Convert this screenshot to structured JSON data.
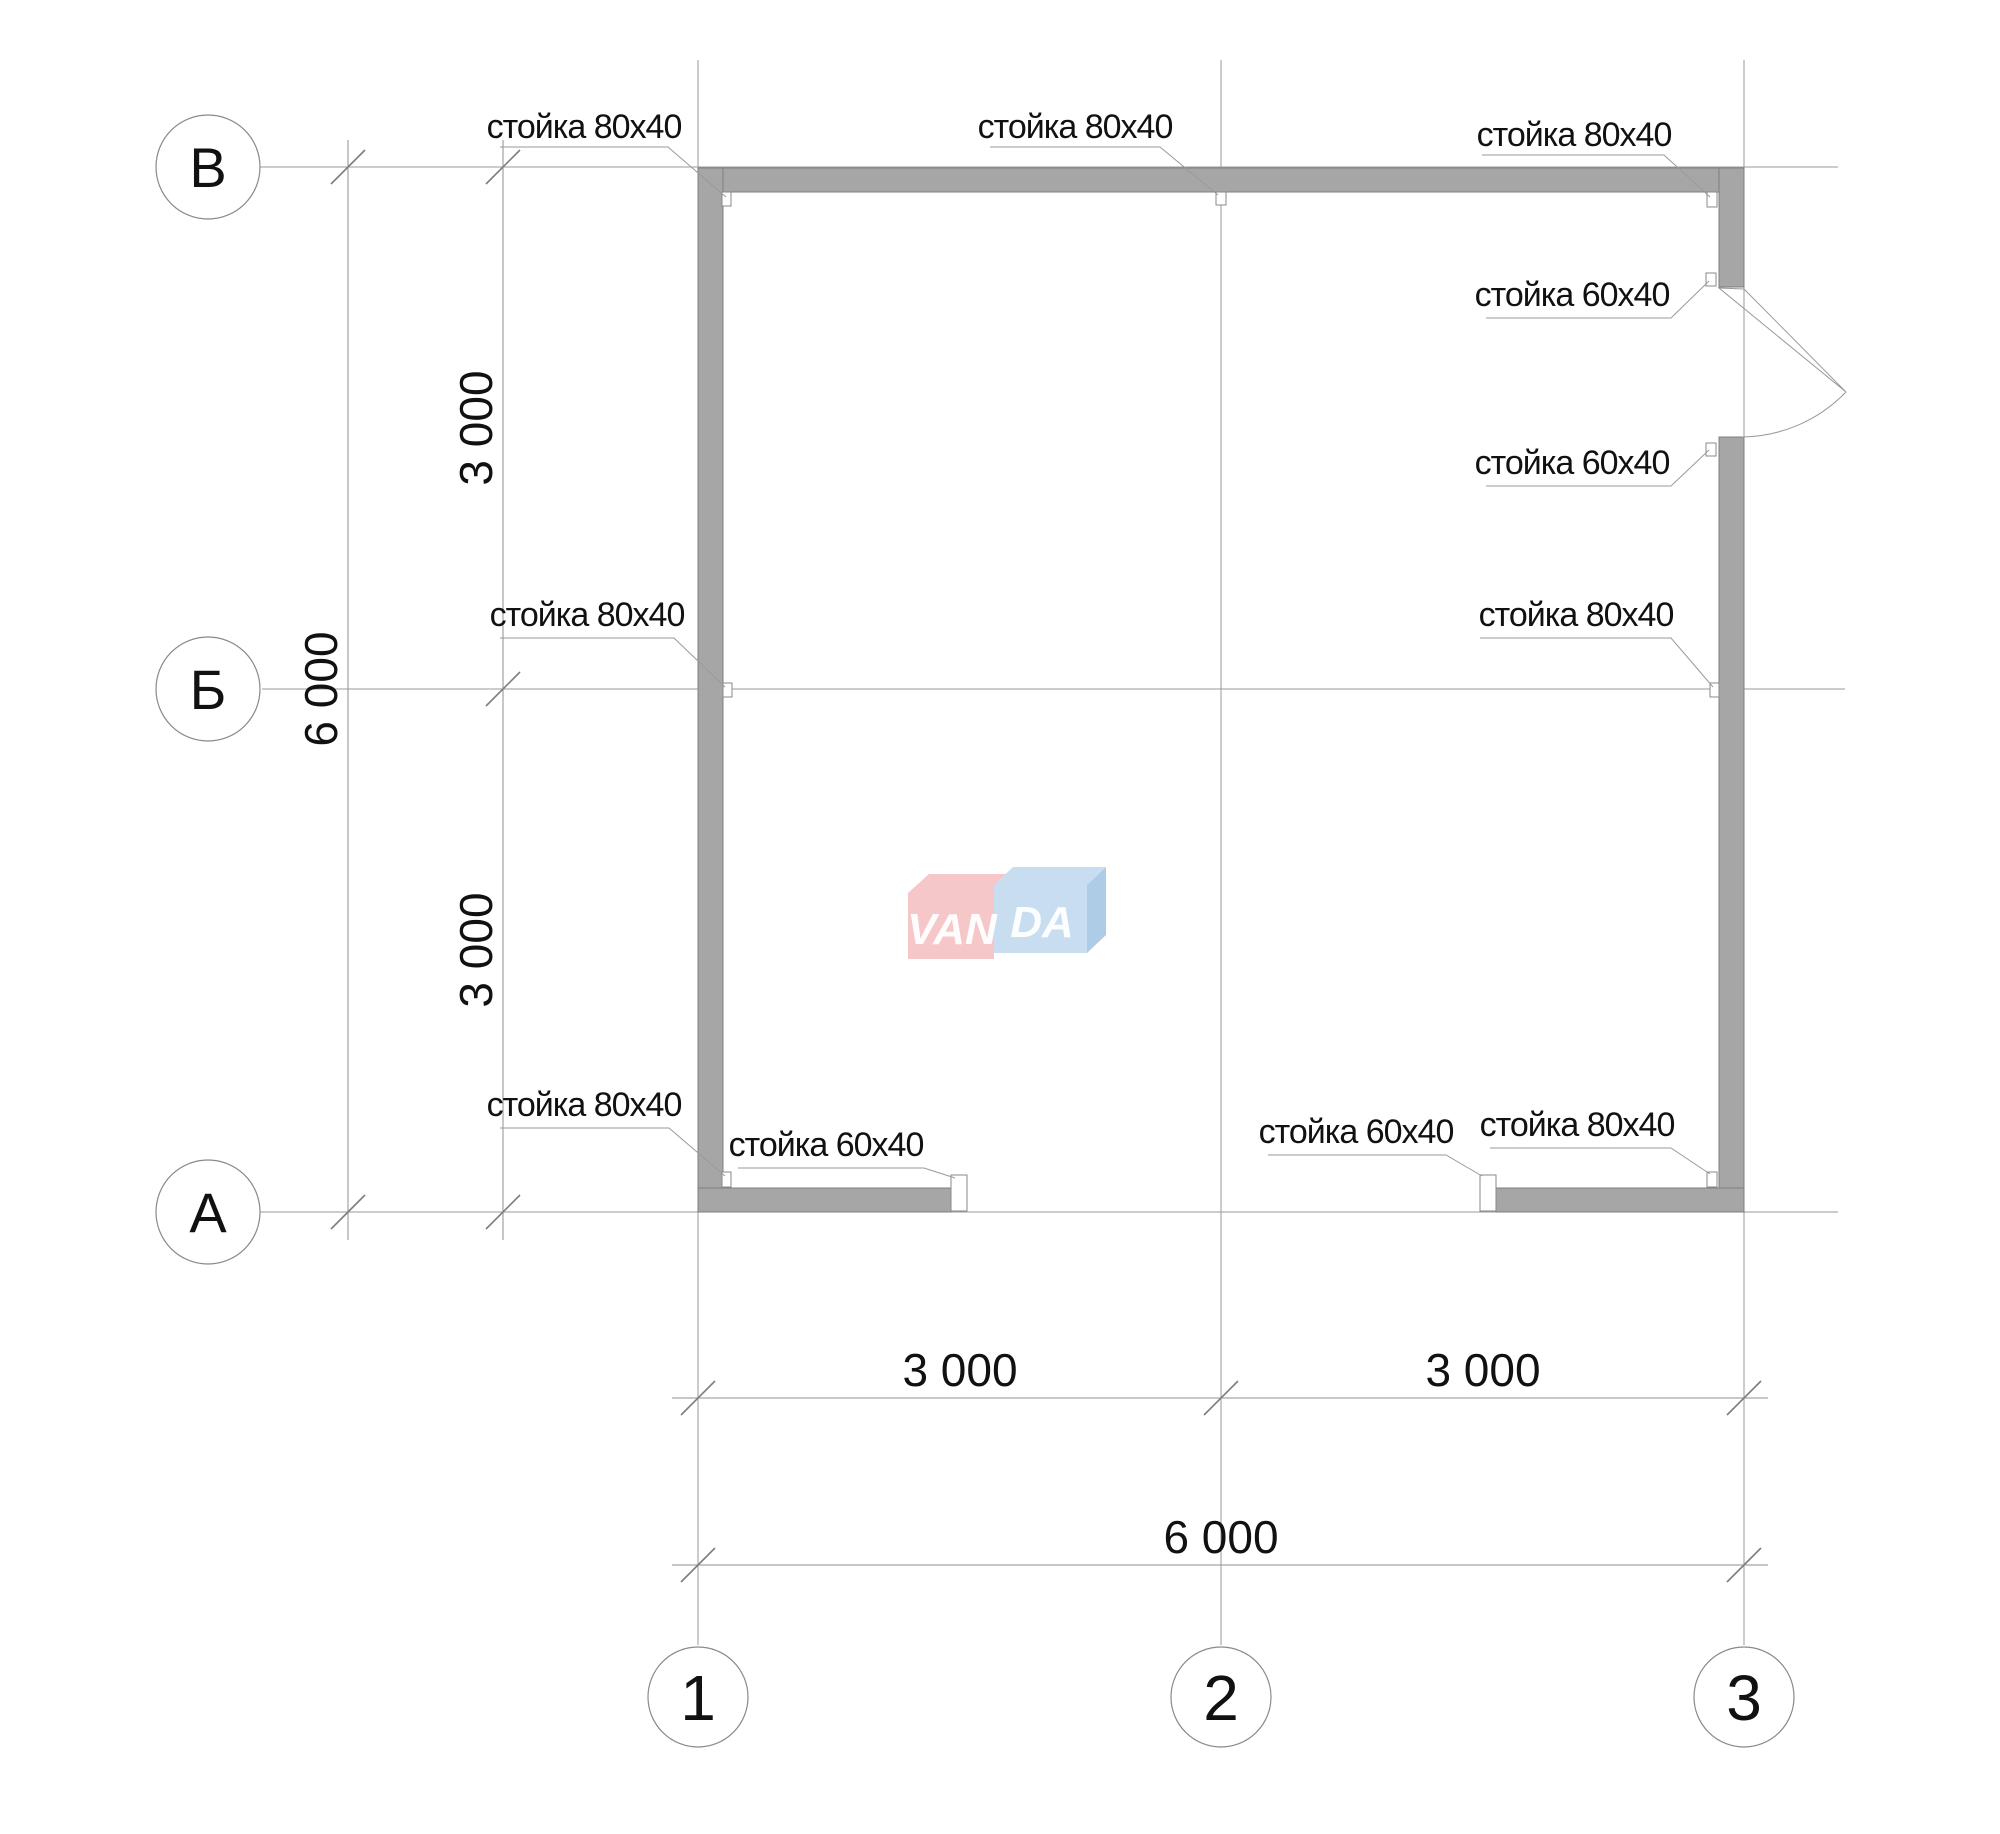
{
  "drawing": {
    "type": "floor-plan",
    "units_note": "dimensions in mm"
  },
  "colors": {
    "wall": "#a6a6a6",
    "line": "#9a9a9a",
    "text": "#111111",
    "logo_pink": "#f5c7c9",
    "logo_blue": "#c8ddf0",
    "logo_blue_side": "#afcce7",
    "white": "#ffffff"
  },
  "grid": {
    "rows": [
      "В",
      "Б",
      "А"
    ],
    "cols": [
      "1",
      "2",
      "3"
    ]
  },
  "dimensions": {
    "bottom": [
      "3 000",
      "3 000",
      "6 000"
    ],
    "left": [
      "3 000",
      "3 000",
      "6 000"
    ]
  },
  "stud_labels": [
    {
      "text": "стойка 80х40",
      "location": "top-left"
    },
    {
      "text": "стойка 80х40",
      "location": "top-center"
    },
    {
      "text": "стойка 80х40",
      "location": "top-right"
    },
    {
      "text": "стойка 60х40",
      "location": "right-door-top"
    },
    {
      "text": "стойка 60х40",
      "location": "right-door-bottom"
    },
    {
      "text": "стойка 80х40",
      "location": "right-axis-b"
    },
    {
      "text": "стойка 80х40",
      "location": "left-axis-b"
    },
    {
      "text": "стойка 80х40",
      "location": "bottom-left-corner"
    },
    {
      "text": "стойка 60х40",
      "location": "bottom-left-opening"
    },
    {
      "text": "стойка 60х40",
      "location": "bottom-right-opening"
    },
    {
      "text": "стойка 80х40",
      "location": "bottom-right-corner"
    }
  ],
  "logo": {
    "left": "VAN",
    "right": "DA"
  }
}
